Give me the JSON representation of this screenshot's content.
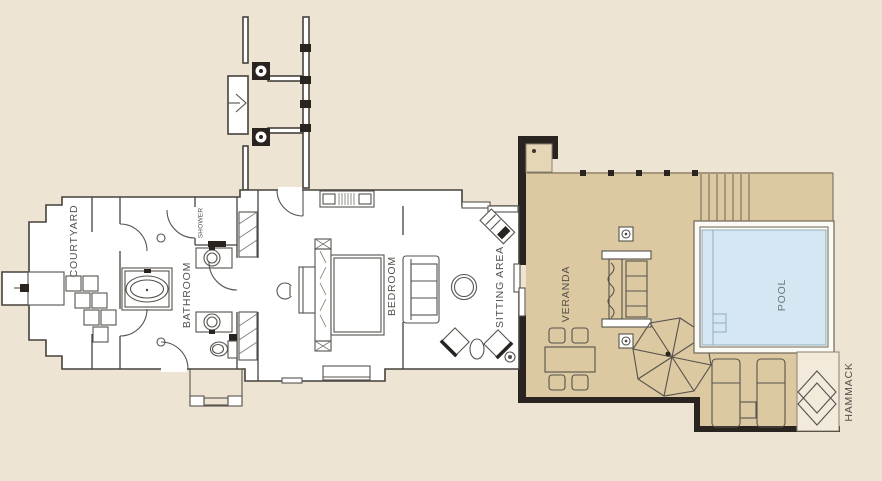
{
  "floorplan": {
    "rooms": [
      {
        "id": "courtyard",
        "label": "COURTYARD"
      },
      {
        "id": "shower",
        "label": "SHOWER"
      },
      {
        "id": "bathroom",
        "label": "BATHROOM"
      },
      {
        "id": "bedroom",
        "label": "BEDROOM"
      },
      {
        "id": "sitting_area",
        "label": "SITTING AREA"
      },
      {
        "id": "veranda",
        "label": "VERANDA"
      },
      {
        "id": "pool",
        "label": "POOL"
      },
      {
        "id": "hammack",
        "label": "HAMMACK"
      }
    ],
    "symbols": [
      "entrance-gate",
      "garden-fence",
      "stepping-stones",
      "outdoor-bench",
      "bathtub",
      "shower-stall",
      "sink-basin",
      "toilet",
      "wardrobe",
      "double-bed",
      "headboard",
      "console-cabinet",
      "sofa",
      "coffee-table",
      "writing-desk",
      "armchair",
      "sliding-door",
      "deck-daybed",
      "dining-table",
      "dining-chair",
      "parasol-umbrella",
      "deck-stairs",
      "pool-steps",
      "sun-lounger",
      "side-table",
      "hammock",
      "deck-post"
    ],
    "colors": {
      "background": "#ede4d3",
      "building": "#ffffff",
      "deck": "#dcc8a1",
      "deck_light": "#e5d6b6",
      "pool_water": "#d5e7f2",
      "pool_frame": "#fbfaf5",
      "hammock_nook": "#f2ebdc",
      "wall": "#45423d",
      "wall_dark": "#29241f",
      "label": "#55514b"
    }
  }
}
